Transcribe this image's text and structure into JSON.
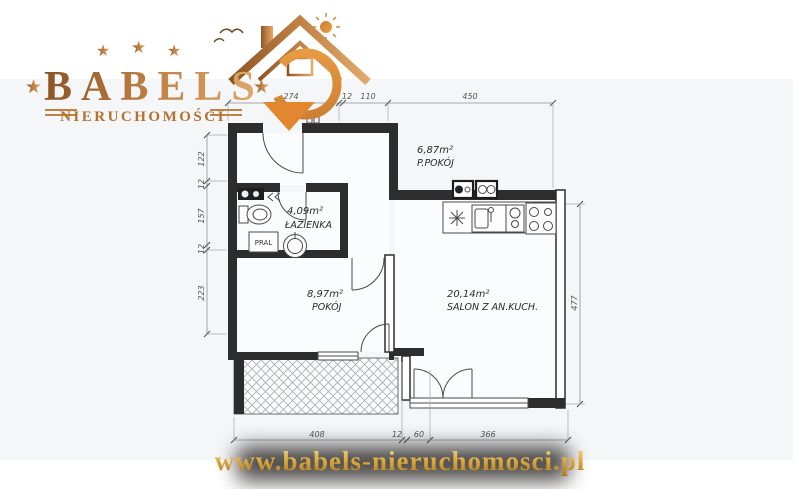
{
  "brand": {
    "name": "BABELS",
    "subtitle": "NIERUCHOMOŚCI",
    "star": "★"
  },
  "footer": {
    "website": "www.babels-nieruchomosci.pl"
  },
  "floorplan": {
    "rooms": [
      {
        "area": "6,87m²",
        "name": "P.POKÓJ"
      },
      {
        "area": "4,09m²",
        "name": "ŁAZIENKA"
      },
      {
        "area": "8,97m²",
        "name": "POKÓJ"
      },
      {
        "area": "20,14m²",
        "name": "SALON Z AN.KUCH."
      }
    ],
    "labels": {
      "washer": "PRAL"
    },
    "dimensions": {
      "top": [
        "274",
        "12",
        "110",
        "450"
      ],
      "left": [
        "122",
        "12",
        "157",
        "12",
        "223"
      ],
      "right": [
        "477"
      ],
      "bottom": [
        "408",
        "12",
        "60",
        "366"
      ]
    },
    "colors": {
      "wall": "#2d2d2d",
      "accent_orange": "#e0872f",
      "gold": "#c08144"
    }
  }
}
